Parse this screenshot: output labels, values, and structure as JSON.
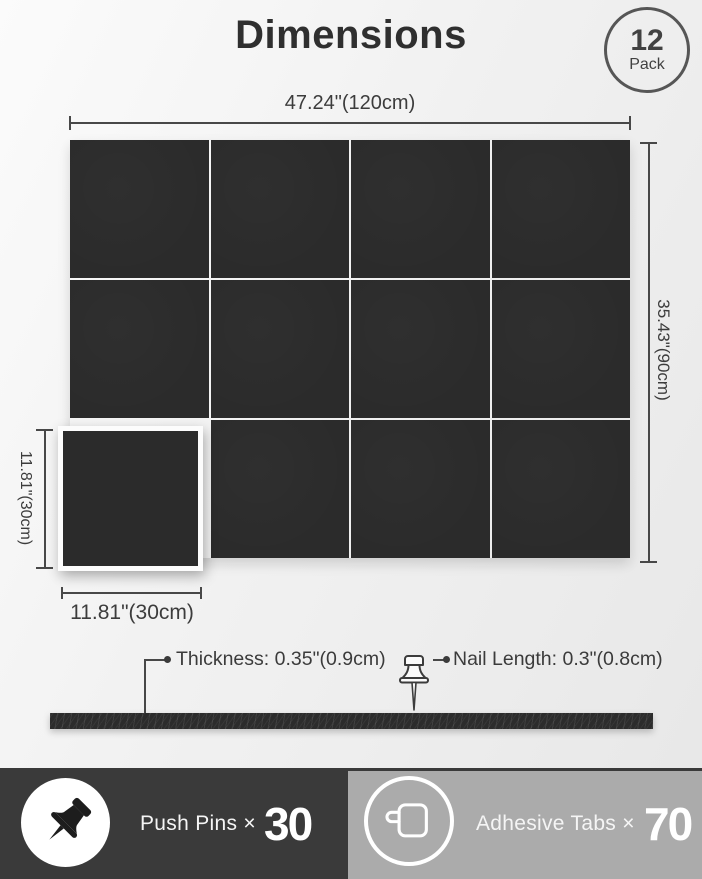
{
  "header": {
    "title": "Dimensions",
    "badge": {
      "count": "12",
      "label": "Pack"
    }
  },
  "diagram": {
    "total_width": "47.24\"(120cm)",
    "total_height": "35.43\"(90cm)",
    "panel_height": "11.81\"(30cm)",
    "panel_width": "11.81\"(30cm)",
    "thickness": "Thickness: 0.35\"(0.9cm)",
    "nail_length": "Nail Length: 0.3\"(0.8cm)",
    "panel_grid": {
      "columns": 4,
      "rows": 3,
      "panel_count": 12
    }
  },
  "footer": {
    "push_pins": {
      "label": "Push Pins ×",
      "count": "30"
    },
    "adhesive_tabs": {
      "label": "Adhesive Tabs ×",
      "count": "70"
    }
  },
  "icons": {
    "push_pin": "push-pin-icon",
    "adhesive_tab": "adhesive-tab-icon",
    "diagram_pin": "push-pin-diagram-icon"
  },
  "colors": {
    "panel": "#2b2b2b",
    "footer_dark": "#3a3a3a",
    "footer_gray": "#ababab",
    "text_dark": "#3d3d3d",
    "text_light": "#ffffff"
  }
}
